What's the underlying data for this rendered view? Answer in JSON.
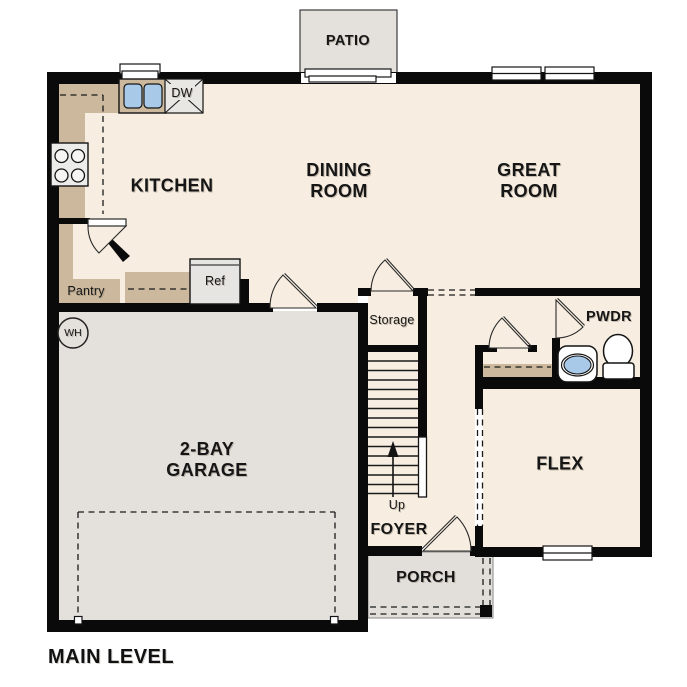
{
  "plan_title": "MAIN LEVEL",
  "rooms": {
    "patio": {
      "label": "PATIO"
    },
    "kitchen": {
      "label": "KITCHEN"
    },
    "dining_room": {
      "lines": [
        "DINING",
        "ROOM"
      ]
    },
    "great_room": {
      "lines": [
        "GREAT",
        "ROOM"
      ]
    },
    "pantry": {
      "label": "Pantry"
    },
    "storage": {
      "label": "Storage"
    },
    "powder_room": {
      "label": "PWDR"
    },
    "garage": {
      "lines": [
        "2-BAY",
        "GARAGE"
      ]
    },
    "flex": {
      "label": "FLEX"
    },
    "foyer": {
      "label": "FOYER"
    },
    "porch": {
      "label": "PORCH"
    }
  },
  "fixtures": {
    "dishwasher": {
      "label": "DW"
    },
    "refrigerator": {
      "label": "Ref"
    },
    "water_heater": {
      "label": "WH"
    },
    "stairs": {
      "direction_label": "Up"
    }
  },
  "colors": {
    "floor": "#f7eee1",
    "cabinetry": "#cbb89d",
    "exterior_concrete": "#e4e1dc",
    "wall": "#0a0a0a",
    "plumbing_blue": "#a9c9e9"
  }
}
